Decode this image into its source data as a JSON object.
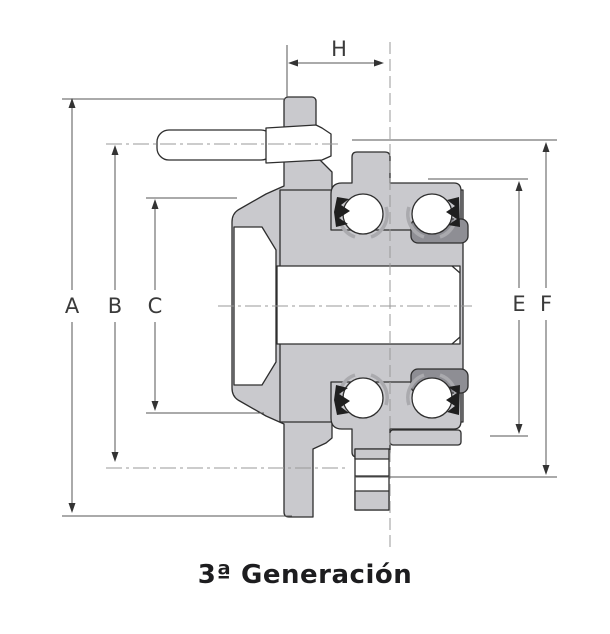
{
  "figure": {
    "caption": "3ª Generación",
    "type_note": "wheel hub bearing cross-section",
    "dimension_labels": {
      "a": "A",
      "b": "B",
      "c": "C",
      "e": "E",
      "f": "F",
      "h": "H"
    },
    "colors": {
      "part_fill": "#c9c9cd",
      "dark_fill": "#8e8e94",
      "seal_fill": "#1f1f1f",
      "outline": "#2e2e2e",
      "dimension_line": "#555555",
      "centerline": "#999999",
      "caption_text": "#1d1d1f"
    }
  }
}
